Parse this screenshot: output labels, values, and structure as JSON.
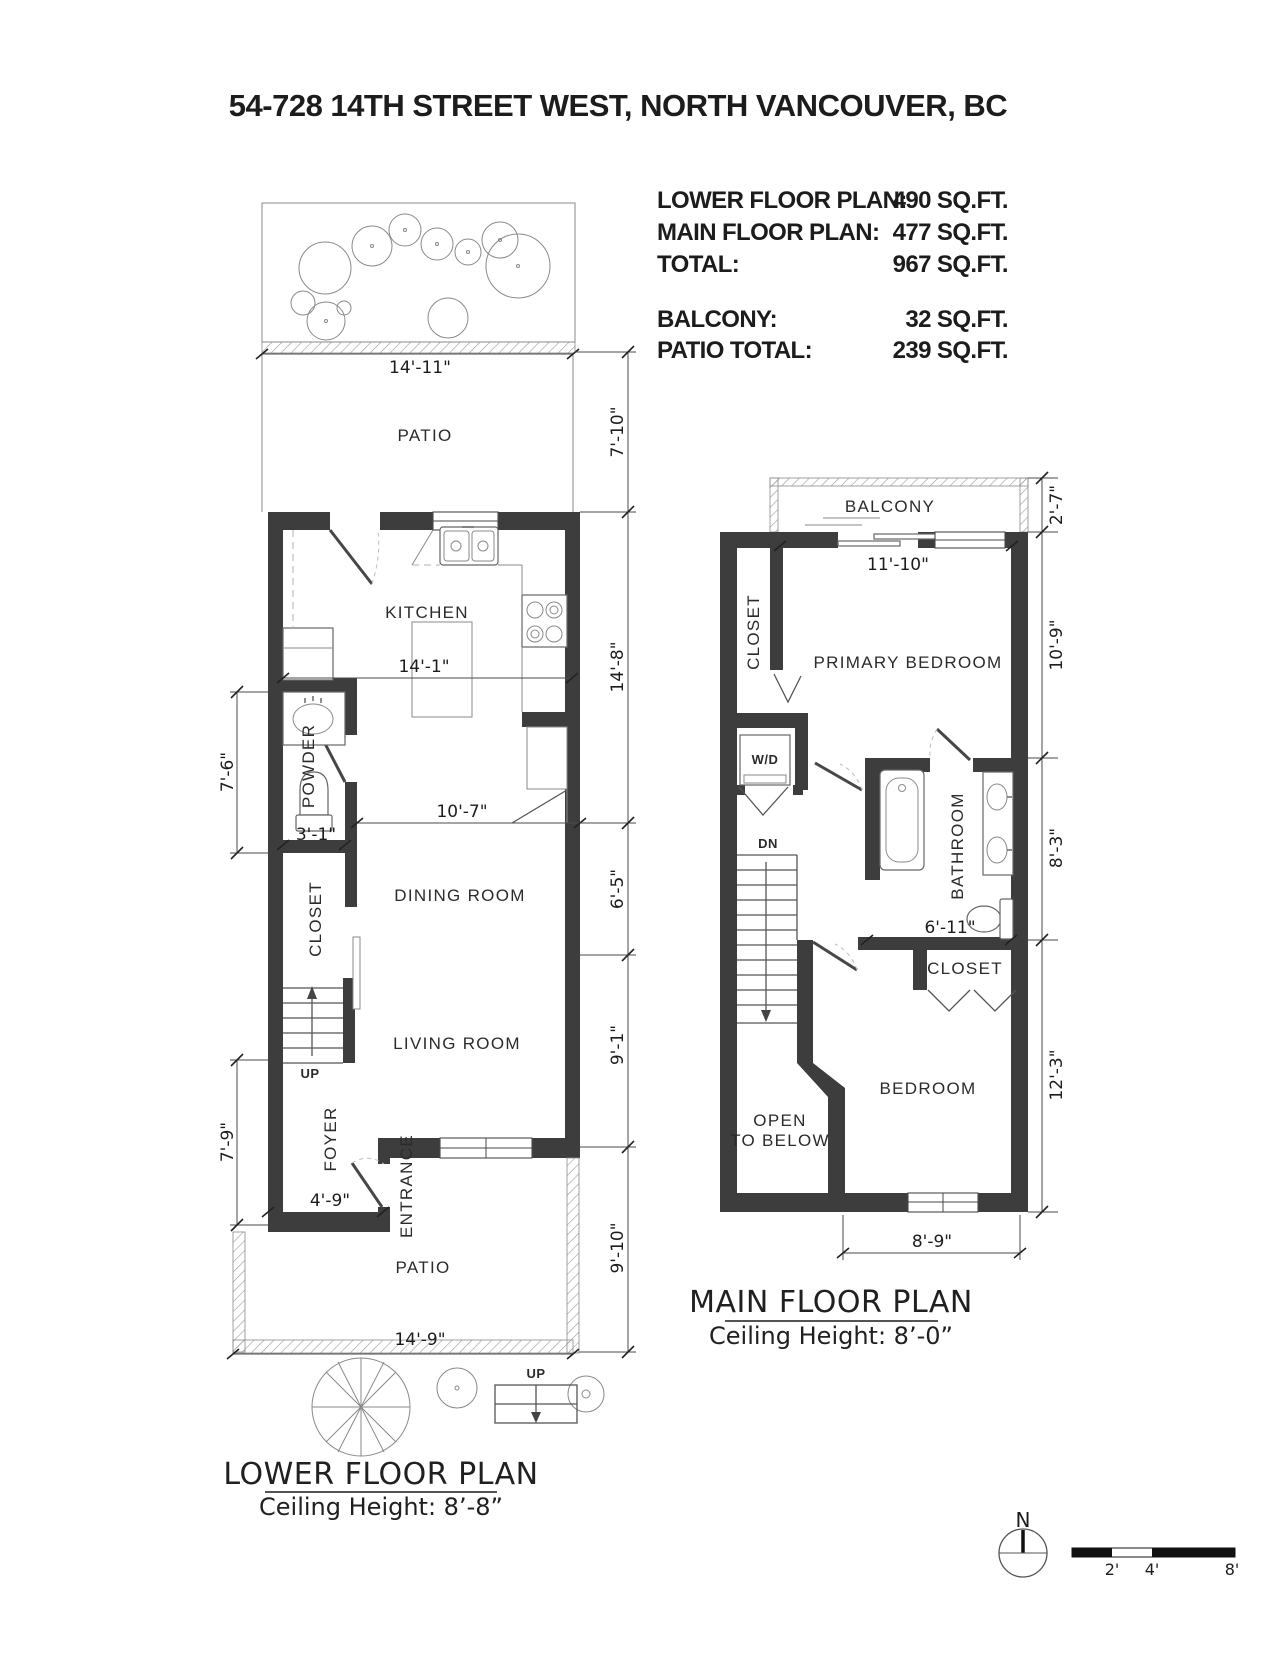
{
  "page_title": "54-728 14TH STREET WEST, NORTH VANCOUVER, BC",
  "colors": {
    "wall": "#3d3d3d",
    "line": "#8a8a8a",
    "text": "#1c1c1c"
  },
  "area_summary": {
    "rows": [
      {
        "label": "LOWER FLOOR PLAN:",
        "value": "490 SQ.FT."
      },
      {
        "label": "MAIN FLOOR PLAN:",
        "value": "477 SQ.FT."
      },
      {
        "label": "TOTAL:",
        "value": "967 SQ.FT."
      },
      {
        "label": "BALCONY:",
        "value": "32 SQ.FT."
      },
      {
        "label": "PATIO TOTAL:",
        "value": "239 SQ.FT."
      }
    ]
  },
  "lower_floor": {
    "name": "LOWER FLOOR PLAN",
    "ceiling_height": "Ceiling Height: 8’-8”",
    "rooms": {
      "patio_top": "PATIO",
      "kitchen": "KITCHEN",
      "powder": "POWDER",
      "closet": "CLOSET",
      "dining": "DINING ROOM",
      "living": "LIVING ROOM",
      "foyer": "FOYER",
      "entrance": "ENTRANCE",
      "patio_bottom": "PATIO",
      "stairs_up": "UP",
      "exterior_steps_up": "UP"
    },
    "dimensions": {
      "patio_top_width": "14'-11\"",
      "patio_top_depth": "7'-10\"",
      "kitchen_width": "14'-1\"",
      "kitchen_depth": "14'-8\"",
      "powder_depth": "7'-6\"",
      "powder_width": "3'-1\"",
      "dining_width": "10'-7\"",
      "dining_depth": "6'-5\"",
      "living_depth": "9'-1\"",
      "foyer_depth": "7'-9\"",
      "foyer_width": "4'-9\"",
      "patio_bottom_width": "14'-9\"",
      "patio_bottom_depth": "9'-10\""
    }
  },
  "main_floor": {
    "name": "MAIN FLOOR PLAN",
    "ceiling_height": "Ceiling Height: 8’-0”",
    "rooms": {
      "balcony": "BALCONY",
      "closet_primary": "CLOSET",
      "primary_bedroom": "PRIMARY BEDROOM",
      "washer_dryer": "W/D",
      "stairs_down": "DN",
      "bathroom": "BATHROOM",
      "closet_bedroom": "CLOSET",
      "bedroom": "BEDROOM",
      "open_below_line1": "OPEN",
      "open_below_line2": "TO BELOW"
    },
    "dimensions": {
      "balcony_depth": "2'-7\"",
      "balcony_width": "11'-10\"",
      "primary_depth": "10'-9\"",
      "bathroom_depth": "8'-3\"",
      "bathroom_width": "6'-11\"",
      "bedroom_depth": "12'-3\"",
      "bedroom_width": "8'-9\""
    }
  },
  "footer": {
    "compass_north": "N",
    "scale_labels": [
      "2'",
      "4'",
      "8'"
    ]
  }
}
